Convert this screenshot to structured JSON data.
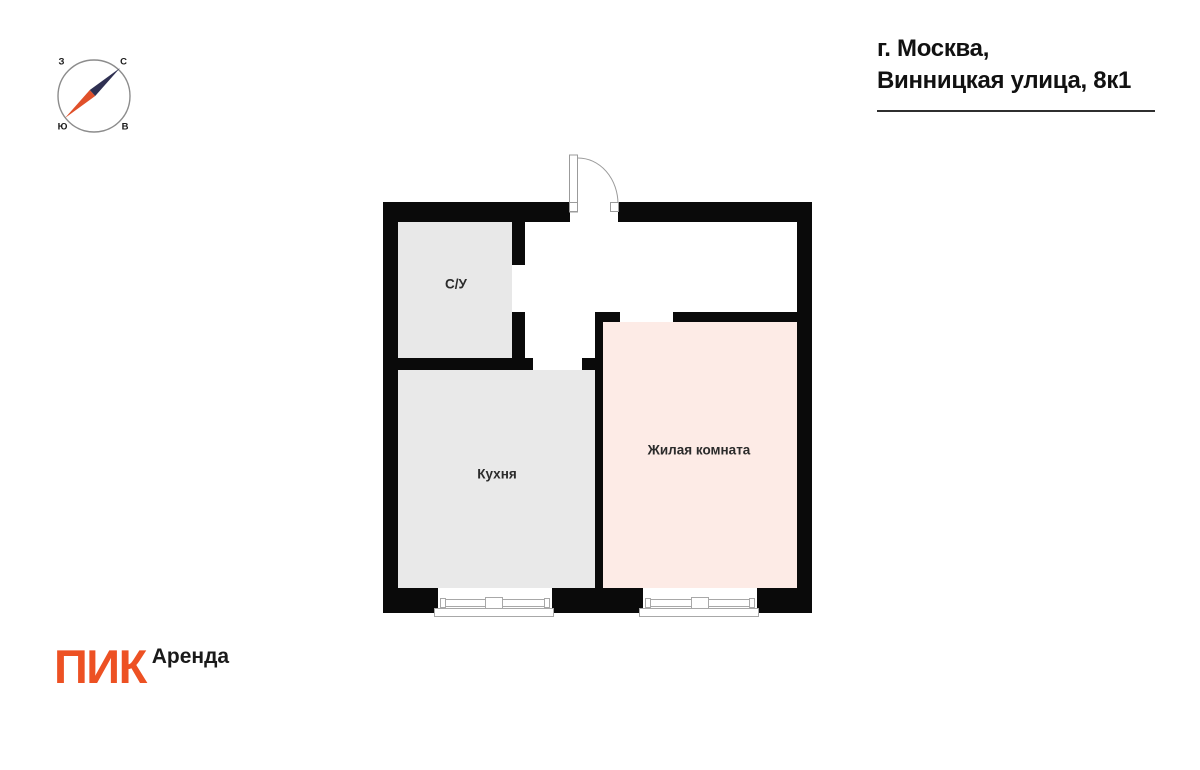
{
  "header": {
    "address_line1": "г. Москва,",
    "address_line2": "Винницкая улица, 8к1"
  },
  "compass": {
    "north_label": "С",
    "south_label": "Ю",
    "west_label": "З",
    "east_label": "В",
    "needle_north_color": "#2f3052",
    "needle_south_color": "#e0502a",
    "ring_color": "#8c8c8c"
  },
  "floor_plan": {
    "wall_color": "#0a0a0a",
    "rooms": [
      {
        "name": "bathroom",
        "label": "С/У",
        "fill": "#e8e8e8"
      },
      {
        "name": "kitchen",
        "label": "Кухня",
        "fill": "#e9e9e9"
      },
      {
        "name": "living_room",
        "label": "Жилая комната",
        "fill": "#fdebe6"
      }
    ]
  },
  "footer": {
    "brand": "ПИК",
    "brand_color": "#ed5123",
    "product": "Аренда"
  }
}
